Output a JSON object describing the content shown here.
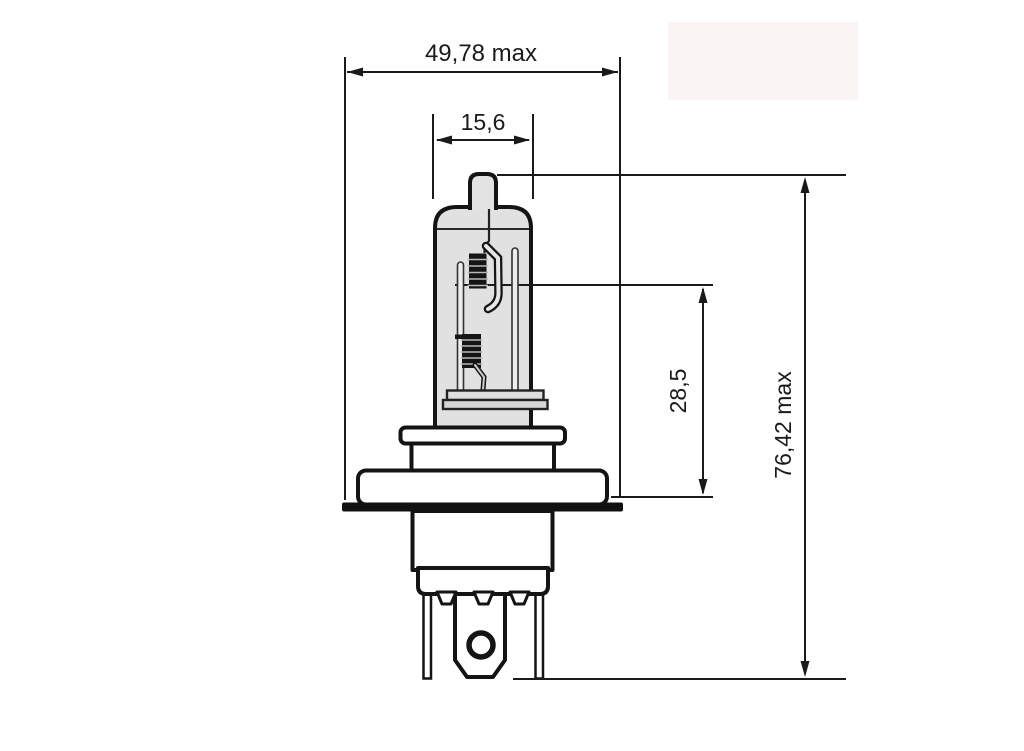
{
  "drawing": {
    "labels": {
      "overall_width": "49,78 max",
      "glass_diameter": "15,6",
      "filament_height": "28,5",
      "overall_length": "76,42 max"
    },
    "values": {
      "overall_width_mm": 49.78,
      "glass_diameter_mm": 15.6,
      "filament_height_mm": 28.5,
      "overall_length_mm": 76.42
    },
    "colors": {
      "line": "#1a1a1a",
      "glass_fill": "#e1e1e1",
      "filament": "#151515",
      "part_fill": "#ffffff",
      "watermark": "#fbf4f4"
    }
  }
}
